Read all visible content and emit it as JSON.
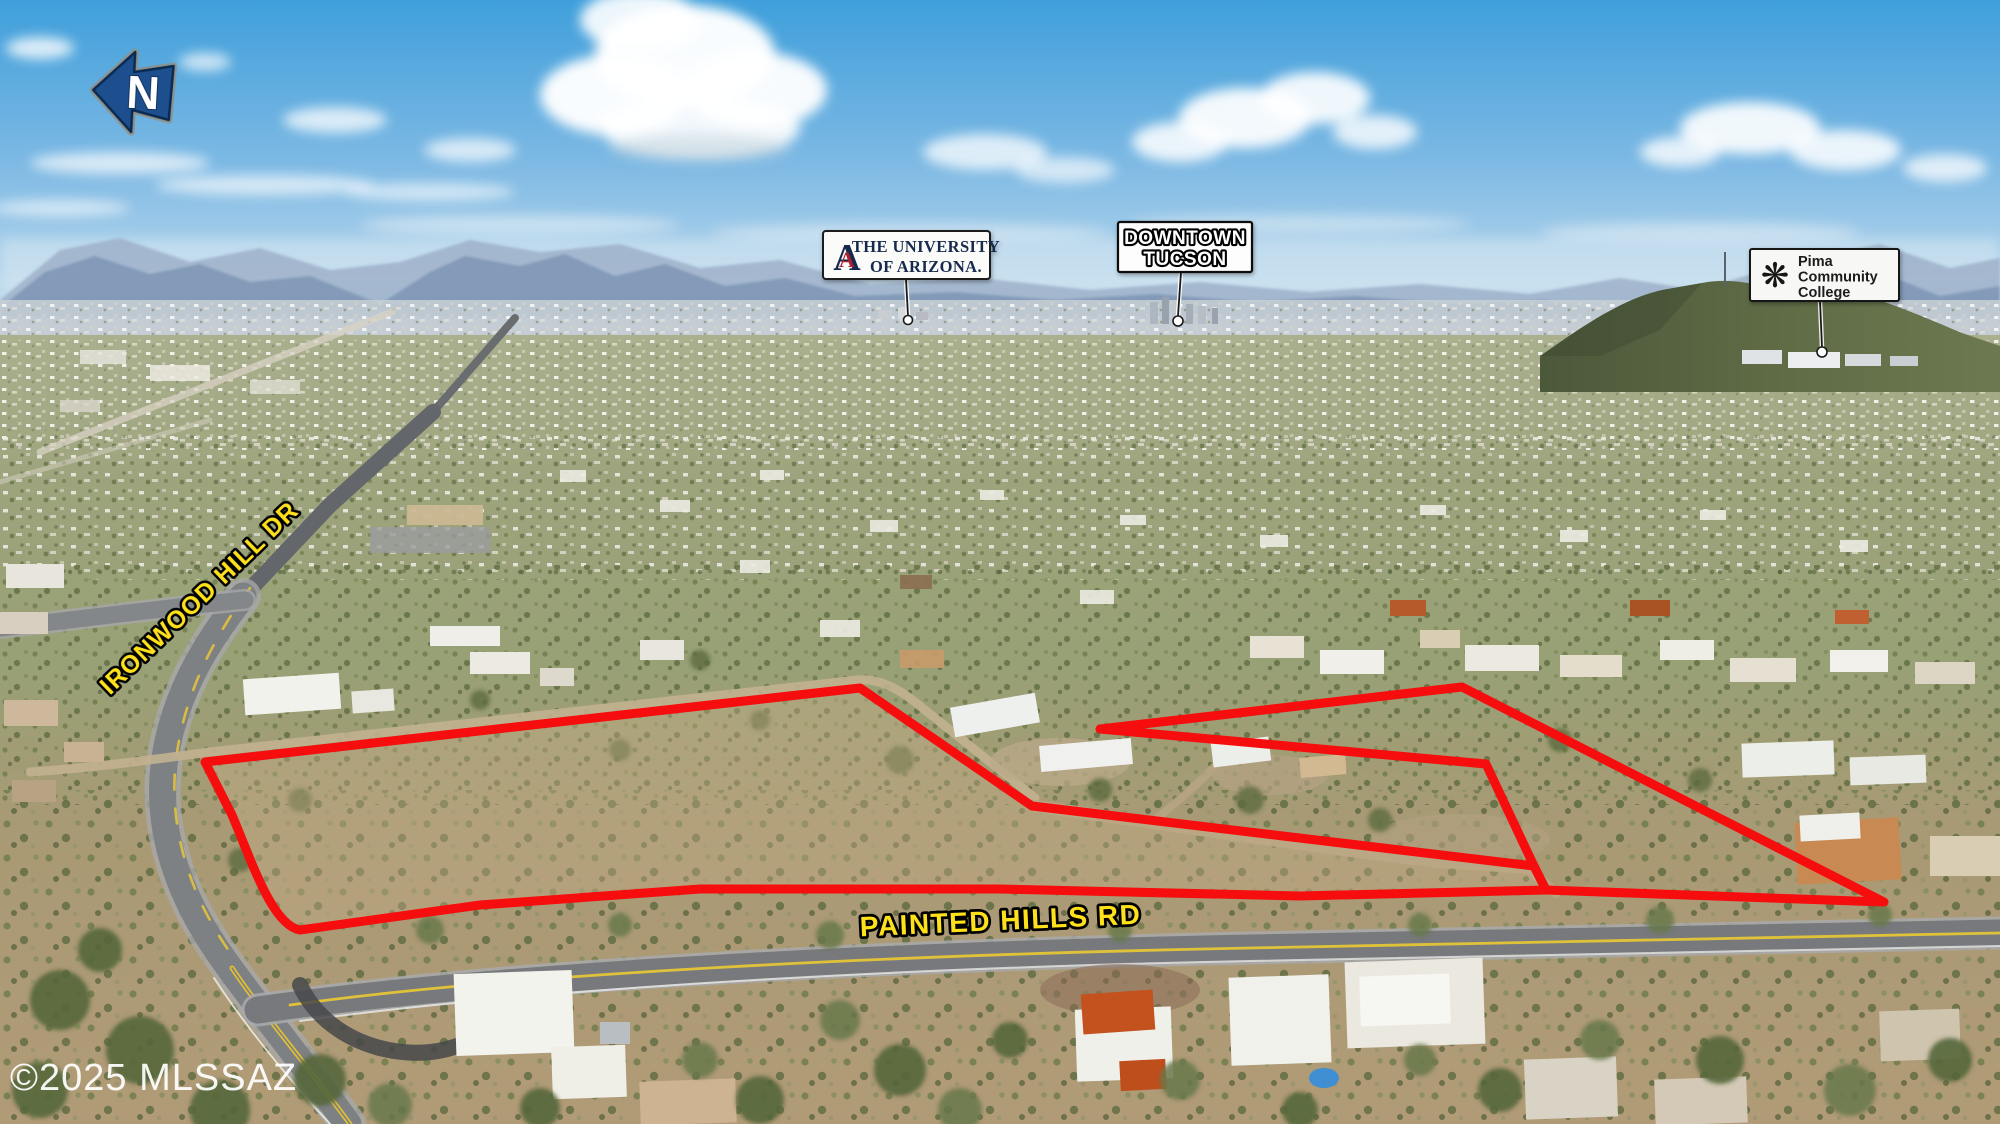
{
  "north_arrow": {
    "label": "N"
  },
  "landmarks": {
    "university": {
      "logo_letter": "A",
      "line1": "THE UNIVERSITY",
      "line2": "OF ARIZONA."
    },
    "downtown": {
      "line1": "DOWNTOWN",
      "line2": "TUCSON"
    },
    "pima": {
      "logo_glyph": "❋",
      "line1": "Pima",
      "line2": "Community",
      "line3": "College"
    }
  },
  "road_labels": {
    "ironwood": "IRONWOOD HILL DR",
    "painted_hills": "PAINTED HILLS RD"
  },
  "watermark": "©2025 MLSSAZ",
  "colors": {
    "boundary_red": "#F60D0D",
    "road_label_yellow": "#FFE11A",
    "north_arrow_blue": "#1D4F8E",
    "ua_navy": "#13294E",
    "ua_red": "#AB2430",
    "pointer_black": "#1A1A1A"
  }
}
